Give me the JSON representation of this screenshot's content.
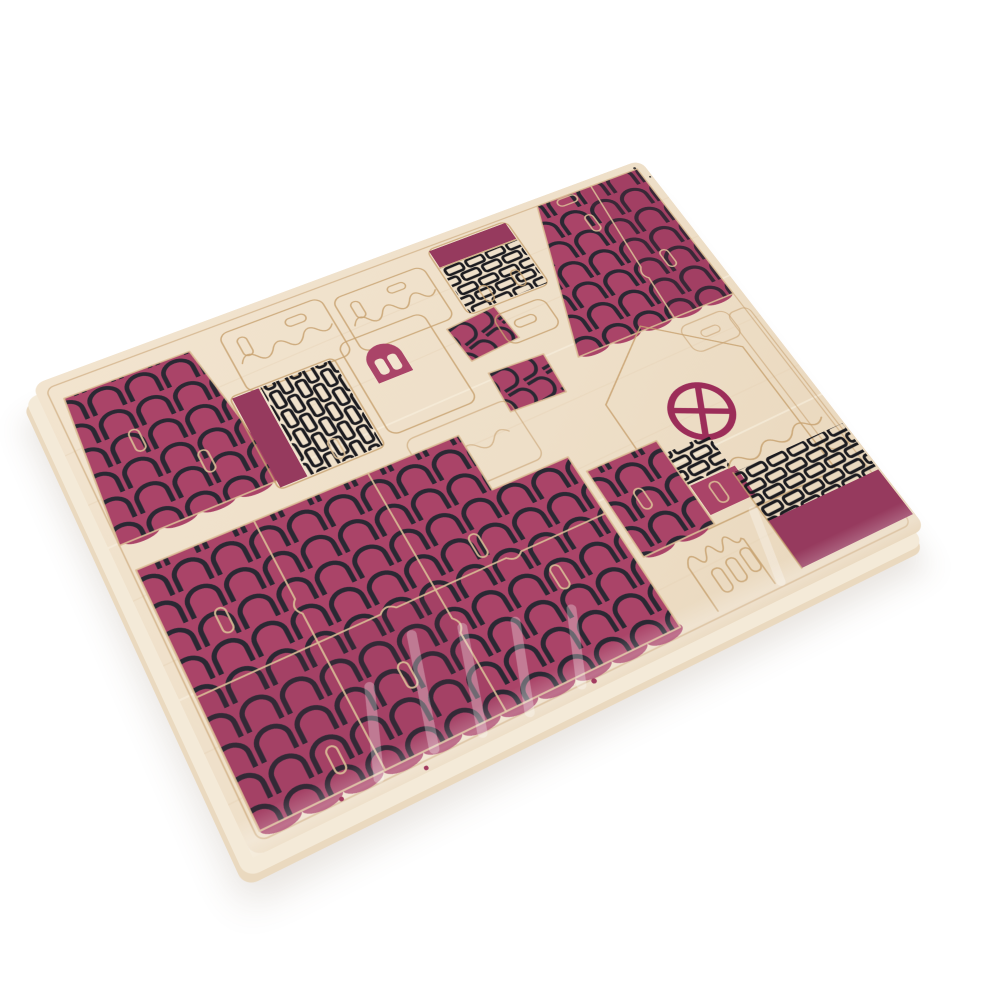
{
  "image": {
    "kind": "product-photo",
    "subject": "Unassembled laser-cut plywood sheet for a DIY miniature house kit, shrink-wrapped, printed with magenta roof-tile, brick, door and window motifs, photographed at an angle on a white background"
  },
  "palette": {
    "background": "#ffffff",
    "wood": "#f2e4cf",
    "wood_mid": "#eedfc8",
    "wood_deep": "#e9d7bc",
    "wood_edge": "#f4ead8",
    "groove": "#c8a271",
    "cut_on_print": "#dcbf97",
    "magenta": "#aa4468",
    "magenta_dark": "#963a5e",
    "tile_line": "#2a2833",
    "brick_line": "#1b1b20",
    "window_ring": "#9c2d59",
    "speck": "#a13a5f",
    "dark_speck": "#3f3a38"
  },
  "board": {
    "shape": "rounded rectangle, tilted with top-left edge receding",
    "material": "light plywood with visible grain and routed cut grooves"
  },
  "pieces": [
    {
      "id": "left-roof-panel",
      "print": "magenta scalloped roof tiles"
    },
    {
      "id": "wall-outline-a",
      "print": "blank wood outline with wavy break cut and slot"
    },
    {
      "id": "wall-outline-b",
      "print": "blank wood outline with wavy break cut and slot"
    },
    {
      "id": "chimney-brick-piece",
      "print": "solid magenta band above black brick courses"
    },
    {
      "id": "top-right-roof-panel",
      "print": "magenta scalloped roof tiles"
    },
    {
      "id": "chimney-column",
      "print": "solid magenta strip beside vertical black brick courses"
    },
    {
      "id": "arch-door-wall",
      "print": "magenta arched door with two light panes"
    },
    {
      "id": "dormer-roof-a",
      "print": "small angled tile print"
    },
    {
      "id": "dormer-roof-b",
      "print": "small angled tile print"
    },
    {
      "id": "gable-wall",
      "print": "round magenta window with cross glazing bars"
    },
    {
      "id": "brick-base-patch",
      "print": "black bricks with solid magenta block and slot"
    },
    {
      "id": "bottom-right-wall",
      "print": "black brick courses over a solid magenta base band"
    },
    {
      "id": "chimney-outline",
      "print": "blank wood, wavy top edge, three oval slots"
    },
    {
      "id": "big-roof-panels",
      "print": "large joined magenta tile roof halves with tab cuts"
    },
    {
      "id": "medium-roof-panel",
      "print": "magenta scalloped roof tiles"
    },
    {
      "id": "misc-outline-pieces",
      "print": "blank wood die-cut outlines and slots"
    }
  ],
  "window": {
    "shape": "circle",
    "glazing_bars": "rotated cross, four panes"
  },
  "wrap": {
    "material": "clear shrink film",
    "wrinkle_highlights": "bottom portion of sheet"
  }
}
